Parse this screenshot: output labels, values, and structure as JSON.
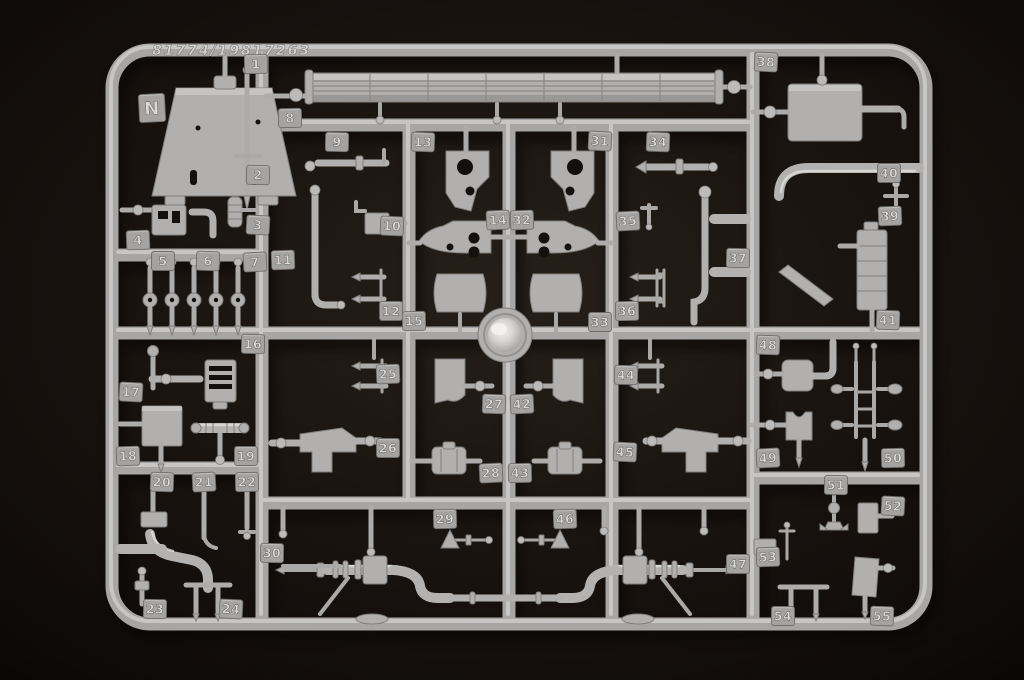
{
  "scene": {
    "description": "Light grey injection-molded model kit parts sprue photographed on a black background",
    "background_color": "#15100d",
    "plastic_color": "#b1b0ae",
    "plastic_highlight": "#dedddb",
    "plastic_shadow": "#7f7e7c",
    "tag_plate_color": "#a4a3a1",
    "tag_text_color": "#dad9d7"
  },
  "sprue": {
    "mold_code": "81774/19817263",
    "runner_letter": "N",
    "part_count": 55,
    "tags": [
      {
        "label": "N",
        "x": 152,
        "y": 108
      },
      {
        "label": "1",
        "x": 256,
        "y": 64
      },
      {
        "label": "2",
        "x": 258,
        "y": 175
      },
      {
        "label": "3",
        "x": 258,
        "y": 225
      },
      {
        "label": "4",
        "x": 138,
        "y": 240
      },
      {
        "label": "5",
        "x": 163,
        "y": 261
      },
      {
        "label": "6",
        "x": 208,
        "y": 261
      },
      {
        "label": "7",
        "x": 255,
        "y": 262
      },
      {
        "label": "8",
        "x": 290,
        "y": 118
      },
      {
        "label": "9",
        "x": 337,
        "y": 142
      },
      {
        "label": "10",
        "x": 392,
        "y": 226
      },
      {
        "label": "11",
        "x": 283,
        "y": 260
      },
      {
        "label": "12",
        "x": 391,
        "y": 311
      },
      {
        "label": "13",
        "x": 423,
        "y": 142
      },
      {
        "label": "14",
        "x": 498,
        "y": 220
      },
      {
        "label": "15",
        "x": 414,
        "y": 321
      },
      {
        "label": "16",
        "x": 253,
        "y": 344
      },
      {
        "label": "17",
        "x": 131,
        "y": 392
      },
      {
        "label": "18",
        "x": 128,
        "y": 456
      },
      {
        "label": "19",
        "x": 246,
        "y": 456
      },
      {
        "label": "20",
        "x": 162,
        "y": 482
      },
      {
        "label": "21",
        "x": 204,
        "y": 482
      },
      {
        "label": "22",
        "x": 247,
        "y": 482
      },
      {
        "label": "23",
        "x": 155,
        "y": 609
      },
      {
        "label": "24",
        "x": 231,
        "y": 609
      },
      {
        "label": "25",
        "x": 388,
        "y": 374
      },
      {
        "label": "26",
        "x": 388,
        "y": 448
      },
      {
        "label": "27",
        "x": 494,
        "y": 404
      },
      {
        "label": "28",
        "x": 491,
        "y": 473
      },
      {
        "label": "29",
        "x": 445,
        "y": 519
      },
      {
        "label": "30",
        "x": 272,
        "y": 553
      },
      {
        "label": "31",
        "x": 600,
        "y": 141
      },
      {
        "label": "32",
        "x": 522,
        "y": 220
      },
      {
        "label": "33",
        "x": 600,
        "y": 322
      },
      {
        "label": "34",
        "x": 658,
        "y": 142
      },
      {
        "label": "35",
        "x": 628,
        "y": 221
      },
      {
        "label": "36",
        "x": 627,
        "y": 311
      },
      {
        "label": "37",
        "x": 738,
        "y": 258
      },
      {
        "label": "38",
        "x": 766,
        "y": 62
      },
      {
        "label": "39",
        "x": 890,
        "y": 216
      },
      {
        "label": "40",
        "x": 889,
        "y": 173
      },
      {
        "label": "41",
        "x": 888,
        "y": 320
      },
      {
        "label": "42",
        "x": 522,
        "y": 404
      },
      {
        "label": "43",
        "x": 520,
        "y": 473
      },
      {
        "label": "44",
        "x": 626,
        "y": 375
      },
      {
        "label": "45",
        "x": 625,
        "y": 452
      },
      {
        "label": "46",
        "x": 565,
        "y": 519
      },
      {
        "label": "47",
        "x": 738,
        "y": 564
      },
      {
        "label": "48",
        "x": 768,
        "y": 345
      },
      {
        "label": "49",
        "x": 768,
        "y": 458
      },
      {
        "label": "50",
        "x": 893,
        "y": 458
      },
      {
        "label": "51",
        "x": 836,
        "y": 485
      },
      {
        "label": "52",
        "x": 893,
        "y": 506
      },
      {
        "label": "53",
        "x": 768,
        "y": 557
      },
      {
        "label": "54",
        "x": 783,
        "y": 616
      },
      {
        "label": "55",
        "x": 882,
        "y": 616
      }
    ]
  }
}
